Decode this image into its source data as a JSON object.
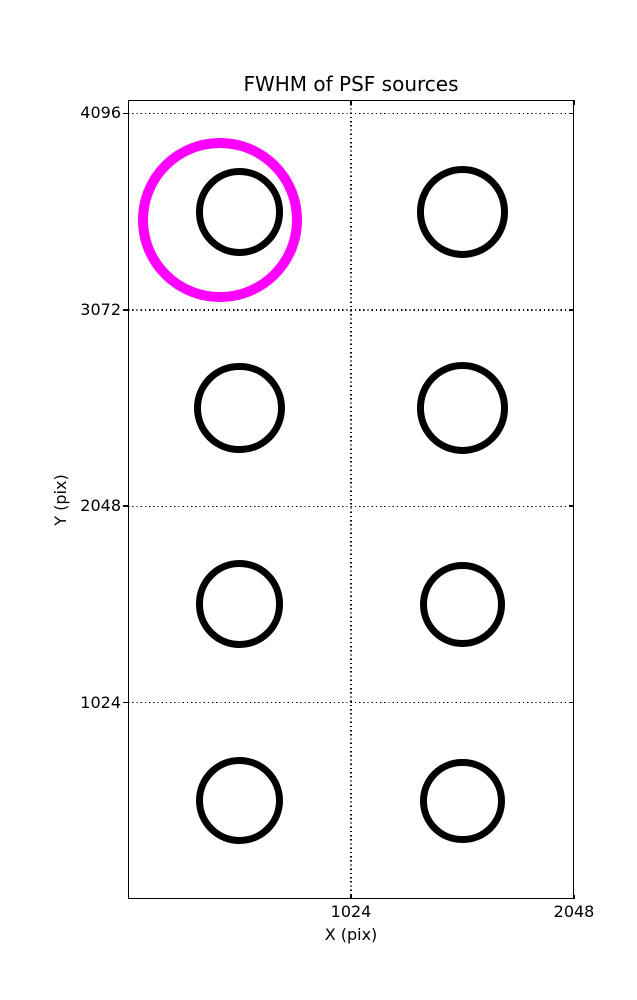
{
  "chart_data": {
    "type": "scatter",
    "title": "FWHM of PSF sources",
    "xlabel": "X (pix)",
    "ylabel": "Y (pix)",
    "xlim": [
      0,
      2048
    ],
    "ylim": [
      0,
      4166
    ],
    "xticks": [
      1024,
      2048
    ],
    "yticks": [
      1024,
      2048,
      3072,
      4096
    ],
    "grid": {
      "style": "dotted",
      "color": "#000000",
      "x_at": [
        1024
      ],
      "y_at": [
        1024,
        2048,
        3072,
        4096
      ]
    },
    "legend": "none",
    "marker_radius_units": "data pixels (x-axis scale)",
    "series": [
      {
        "name": "psf-sources",
        "marker": "open-circle",
        "color": "#000000",
        "linewidth_px": 7,
        "points": [
          {
            "x": 512,
            "y": 3584,
            "r": 202
          },
          {
            "x": 1536,
            "y": 3584,
            "r": 211
          },
          {
            "x": 512,
            "y": 2560,
            "r": 207
          },
          {
            "x": 1536,
            "y": 2560,
            "r": 211
          },
          {
            "x": 512,
            "y": 1536,
            "r": 202
          },
          {
            "x": 1536,
            "y": 1536,
            "r": 197
          },
          {
            "x": 512,
            "y": 512,
            "r": 200
          },
          {
            "x": 1536,
            "y": 512,
            "r": 193
          }
        ]
      },
      {
        "name": "highlight-circle",
        "marker": "open-circle",
        "color": "#ff00ff",
        "linewidth_px": 10,
        "points": [
          {
            "x": 422,
            "y": 3540,
            "r": 376
          }
        ]
      }
    ]
  },
  "colors": {
    "foreground": "#000000",
    "background": "#ffffff",
    "highlight": "#ff00ff"
  }
}
